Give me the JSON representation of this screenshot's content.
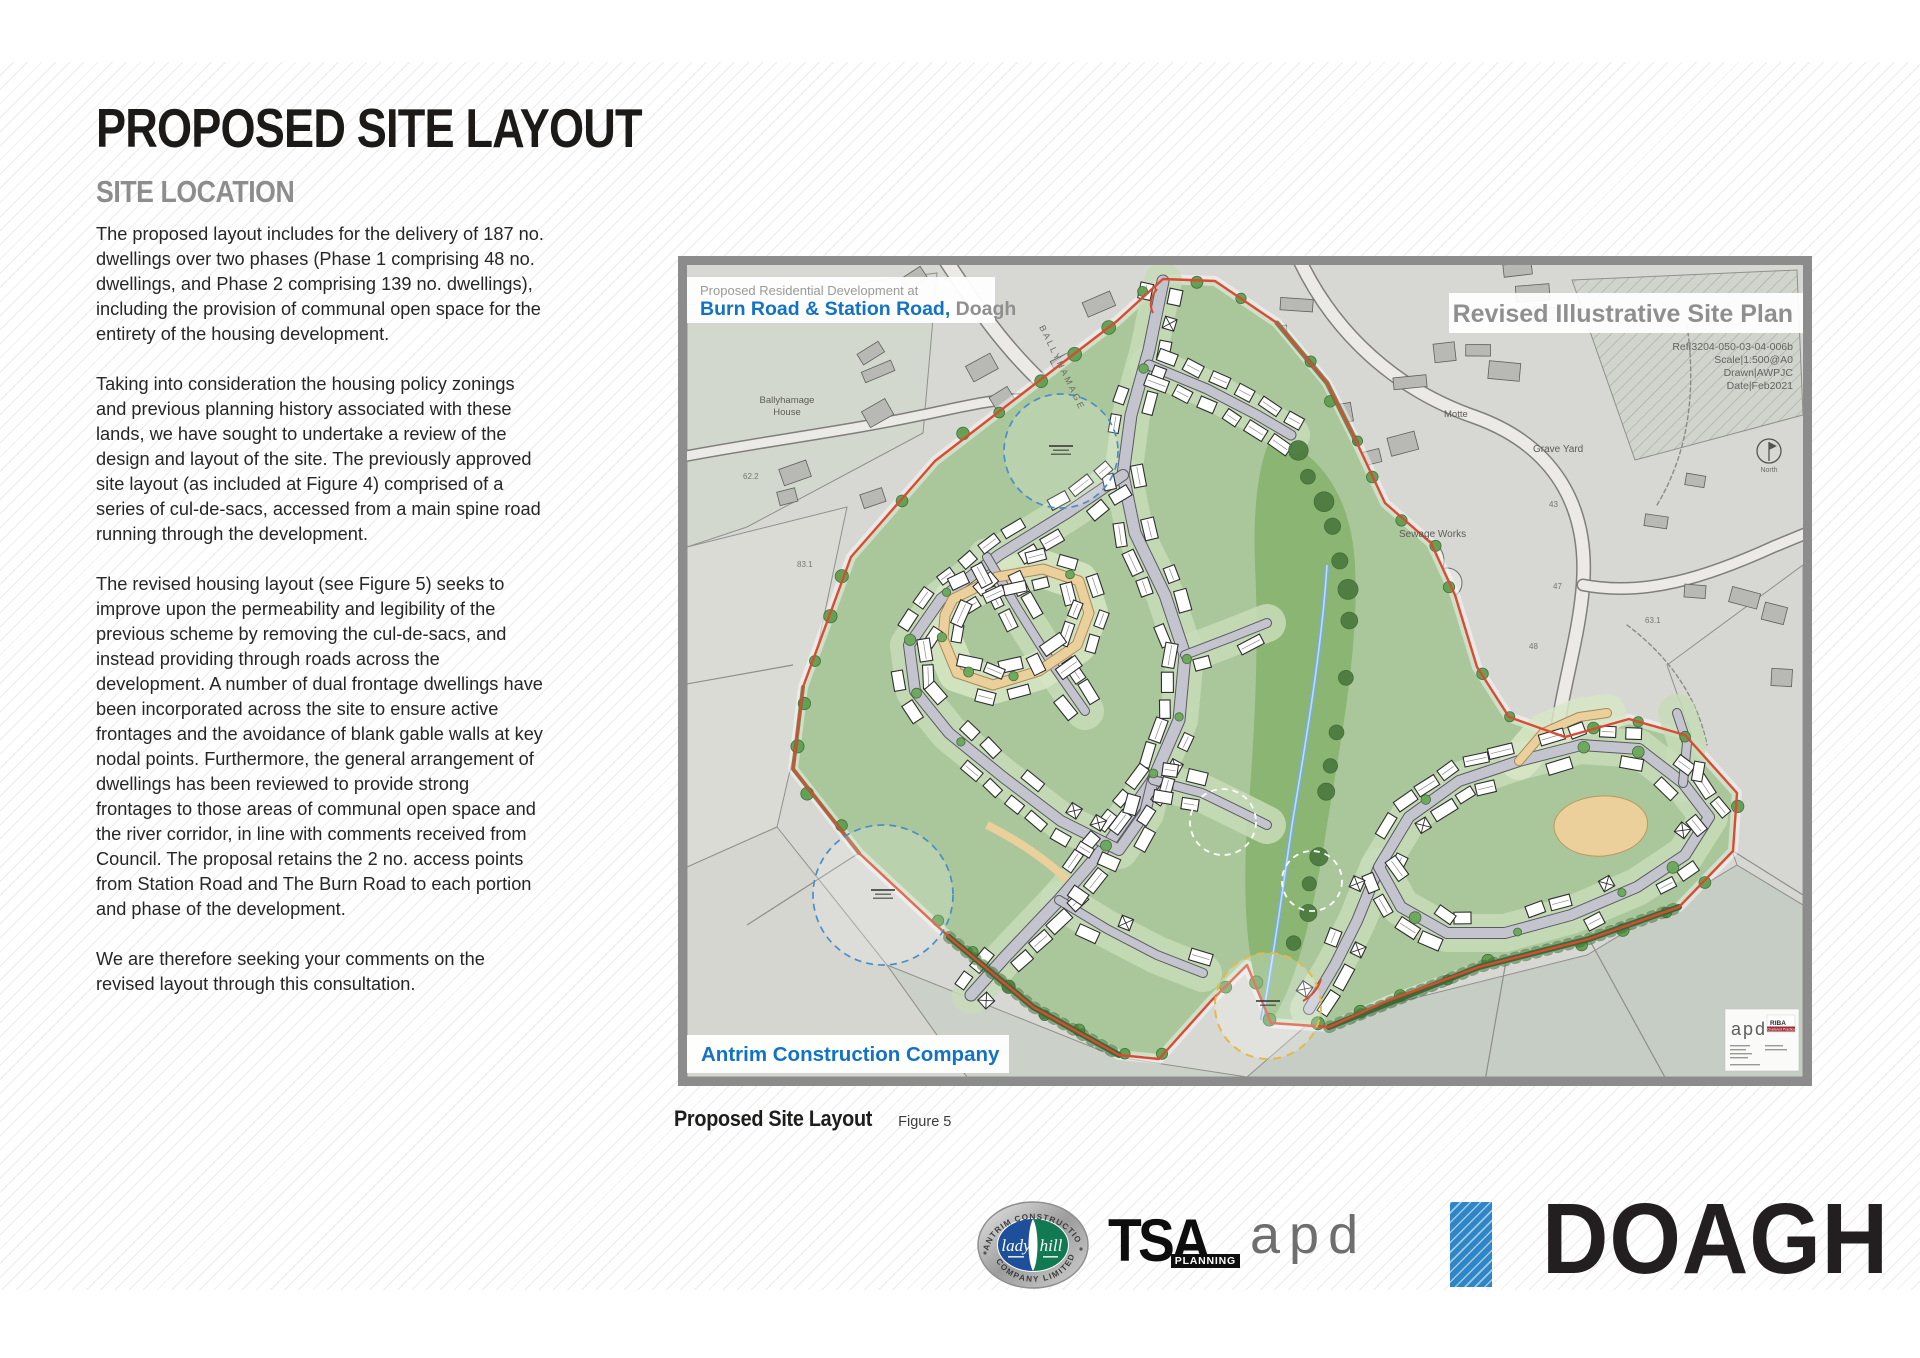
{
  "page": {
    "title": "PROPOSED SITE LAYOUT",
    "subtitle": "SITE LOCATION",
    "paragraphs": [
      "The proposed layout includes for the delivery of 187 no. dwellings over two phases (Phase 1 comprising 48 no. dwellings, and Phase 2 comprising 139 no. dwellings), including the provision of communal open space for the entirety of the housing development.",
      "Taking into consideration the housing policy zonings and previous planning history associated with these lands, we have sought to undertake a review of the design and layout of the site. The previously approved site layout (as included at Figure 4) comprised of a series of cul-de-sacs, accessed from a main spine road running through the development.",
      "The revised housing layout (see Figure 5) seeks to improve upon the permeability and legibility of the previous scheme by removing the cul-de-sacs, and instead providing through roads across the development. A number of dual frontage dwellings have been incorporated across the site to ensure active frontages and the avoidance of blank gable walls at key nodal points. Furthermore, the general arrangement of dwellings has been reviewed to provide strong frontages to those areas of communal open space and the river corridor, in line with comments received from Council. The proposal retains the 2 no. access points from Station Road and The Burn Road to each portion and phase of the development.",
      "We are therefore seeking your comments on the revised layout through this consultation."
    ]
  },
  "figure": {
    "caption_bold": "Proposed Site Layout",
    "caption_label": "Figure 5"
  },
  "plan": {
    "header_small": "Proposed Residential Development at",
    "header_blue": "Burn Road & Station Road,",
    "header_gray": " Doagh",
    "title": "Revised Illustrative Site Plan",
    "ref": [
      "Ref|3204-050-03-04-006b",
      "Scale|1:500@A0",
      "Drawn|AWPJC",
      "Date|Feb2021"
    ],
    "company_banner": "Antrim Construction Company",
    "north_label": "North",
    "labels": {
      "ballyhamage_1": "Ballyhamage",
      "ballyhamage_2": "House",
      "road_name": "BALLYHAMAGE",
      "motte": "Motte",
      "grave_yard": "Grave Yard",
      "sewage_works": "Sewage Works",
      "n43": "43",
      "n47": "47",
      "n48": "48",
      "n631": "63.1",
      "n831": "83.1",
      "n622": "62.2"
    },
    "apd_box": {
      "logo": "apd",
      "riba": "RIBA",
      "riba_sub": "Chartered Practice"
    }
  },
  "logos": {
    "acc_arc_top": "ANTRIM CONSTRUCTION",
    "acc_arc_bottom": "COMPANY LIMITED",
    "acc_left": "lady",
    "acc_right": "hill",
    "tsa": "TSA",
    "tsa_sub": "PLANNING",
    "apd": "apd",
    "doagh": "DOAGH"
  },
  "colors": {
    "brand_blue": "#1273c6",
    "boundary_red": "#d94b32",
    "doagh_blue": "#2e86c6",
    "frame_gray": "#8c8c8c",
    "subtitle_gray": "#8d8d8d"
  }
}
